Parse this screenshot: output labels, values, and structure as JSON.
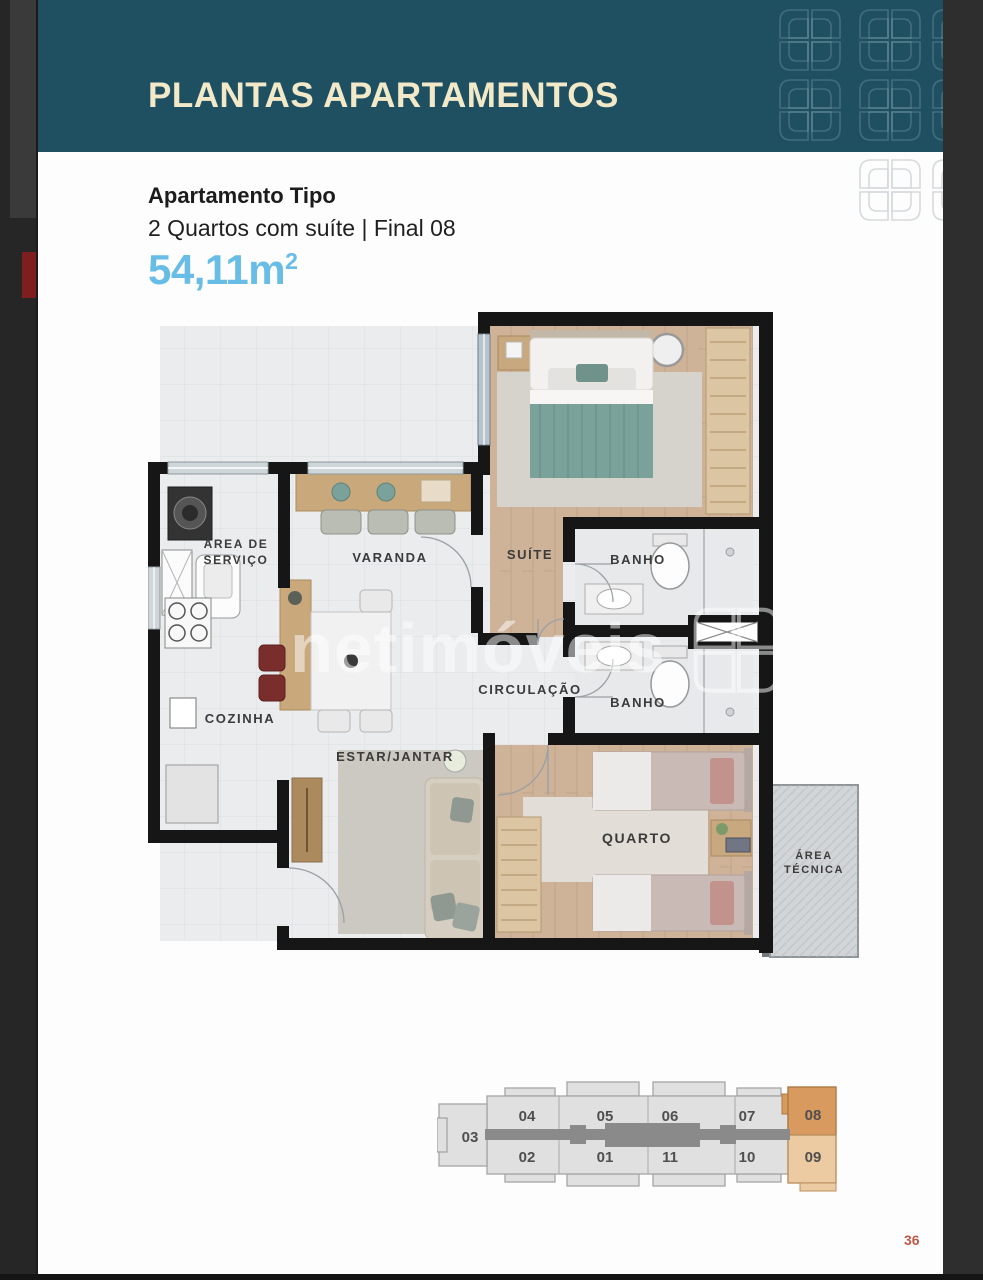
{
  "banner": {
    "title": "PLANTAS APARTAMENTOS",
    "bg_color": "#1f5062",
    "title_color": "#f2e9c8"
  },
  "info": {
    "heading": "Apartamento Tipo",
    "subtitle": "2 Quartos com suíte | Final 08",
    "area_value": "54,11m",
    "area_sup": "2",
    "area_color": "#67bde6"
  },
  "floorplan": {
    "watermark": "netimóveis",
    "rooms": {
      "servico_line1": "ÁREA DE",
      "servico_line2": "SERVIÇO",
      "varanda": "VARANDA",
      "suite": "SUÍTE",
      "banho_suite": "BANHO",
      "cozinha": "COZINHA",
      "circulacao": "CIRCULAÇÃO",
      "banho_social": "BANHO",
      "estar": "ESTAR/JANTAR",
      "quarto": "QUARTO",
      "tecnica_line1": "ÁREA",
      "tecnica_line2": "TÉCNICA"
    }
  },
  "keyplan": {
    "highlighted_unit": "08",
    "secondary_unit": "09",
    "highlight_color": "#d89a5e",
    "secondary_color": "#eccaa2",
    "units": {
      "u03": "03",
      "u04": "04",
      "u05": "05",
      "u06": "06",
      "u07": "07",
      "u08": "08",
      "u02": "02",
      "u01": "01",
      "u11": "11",
      "u10": "10",
      "u09": "09"
    }
  },
  "footer": {
    "page_number": "36"
  }
}
